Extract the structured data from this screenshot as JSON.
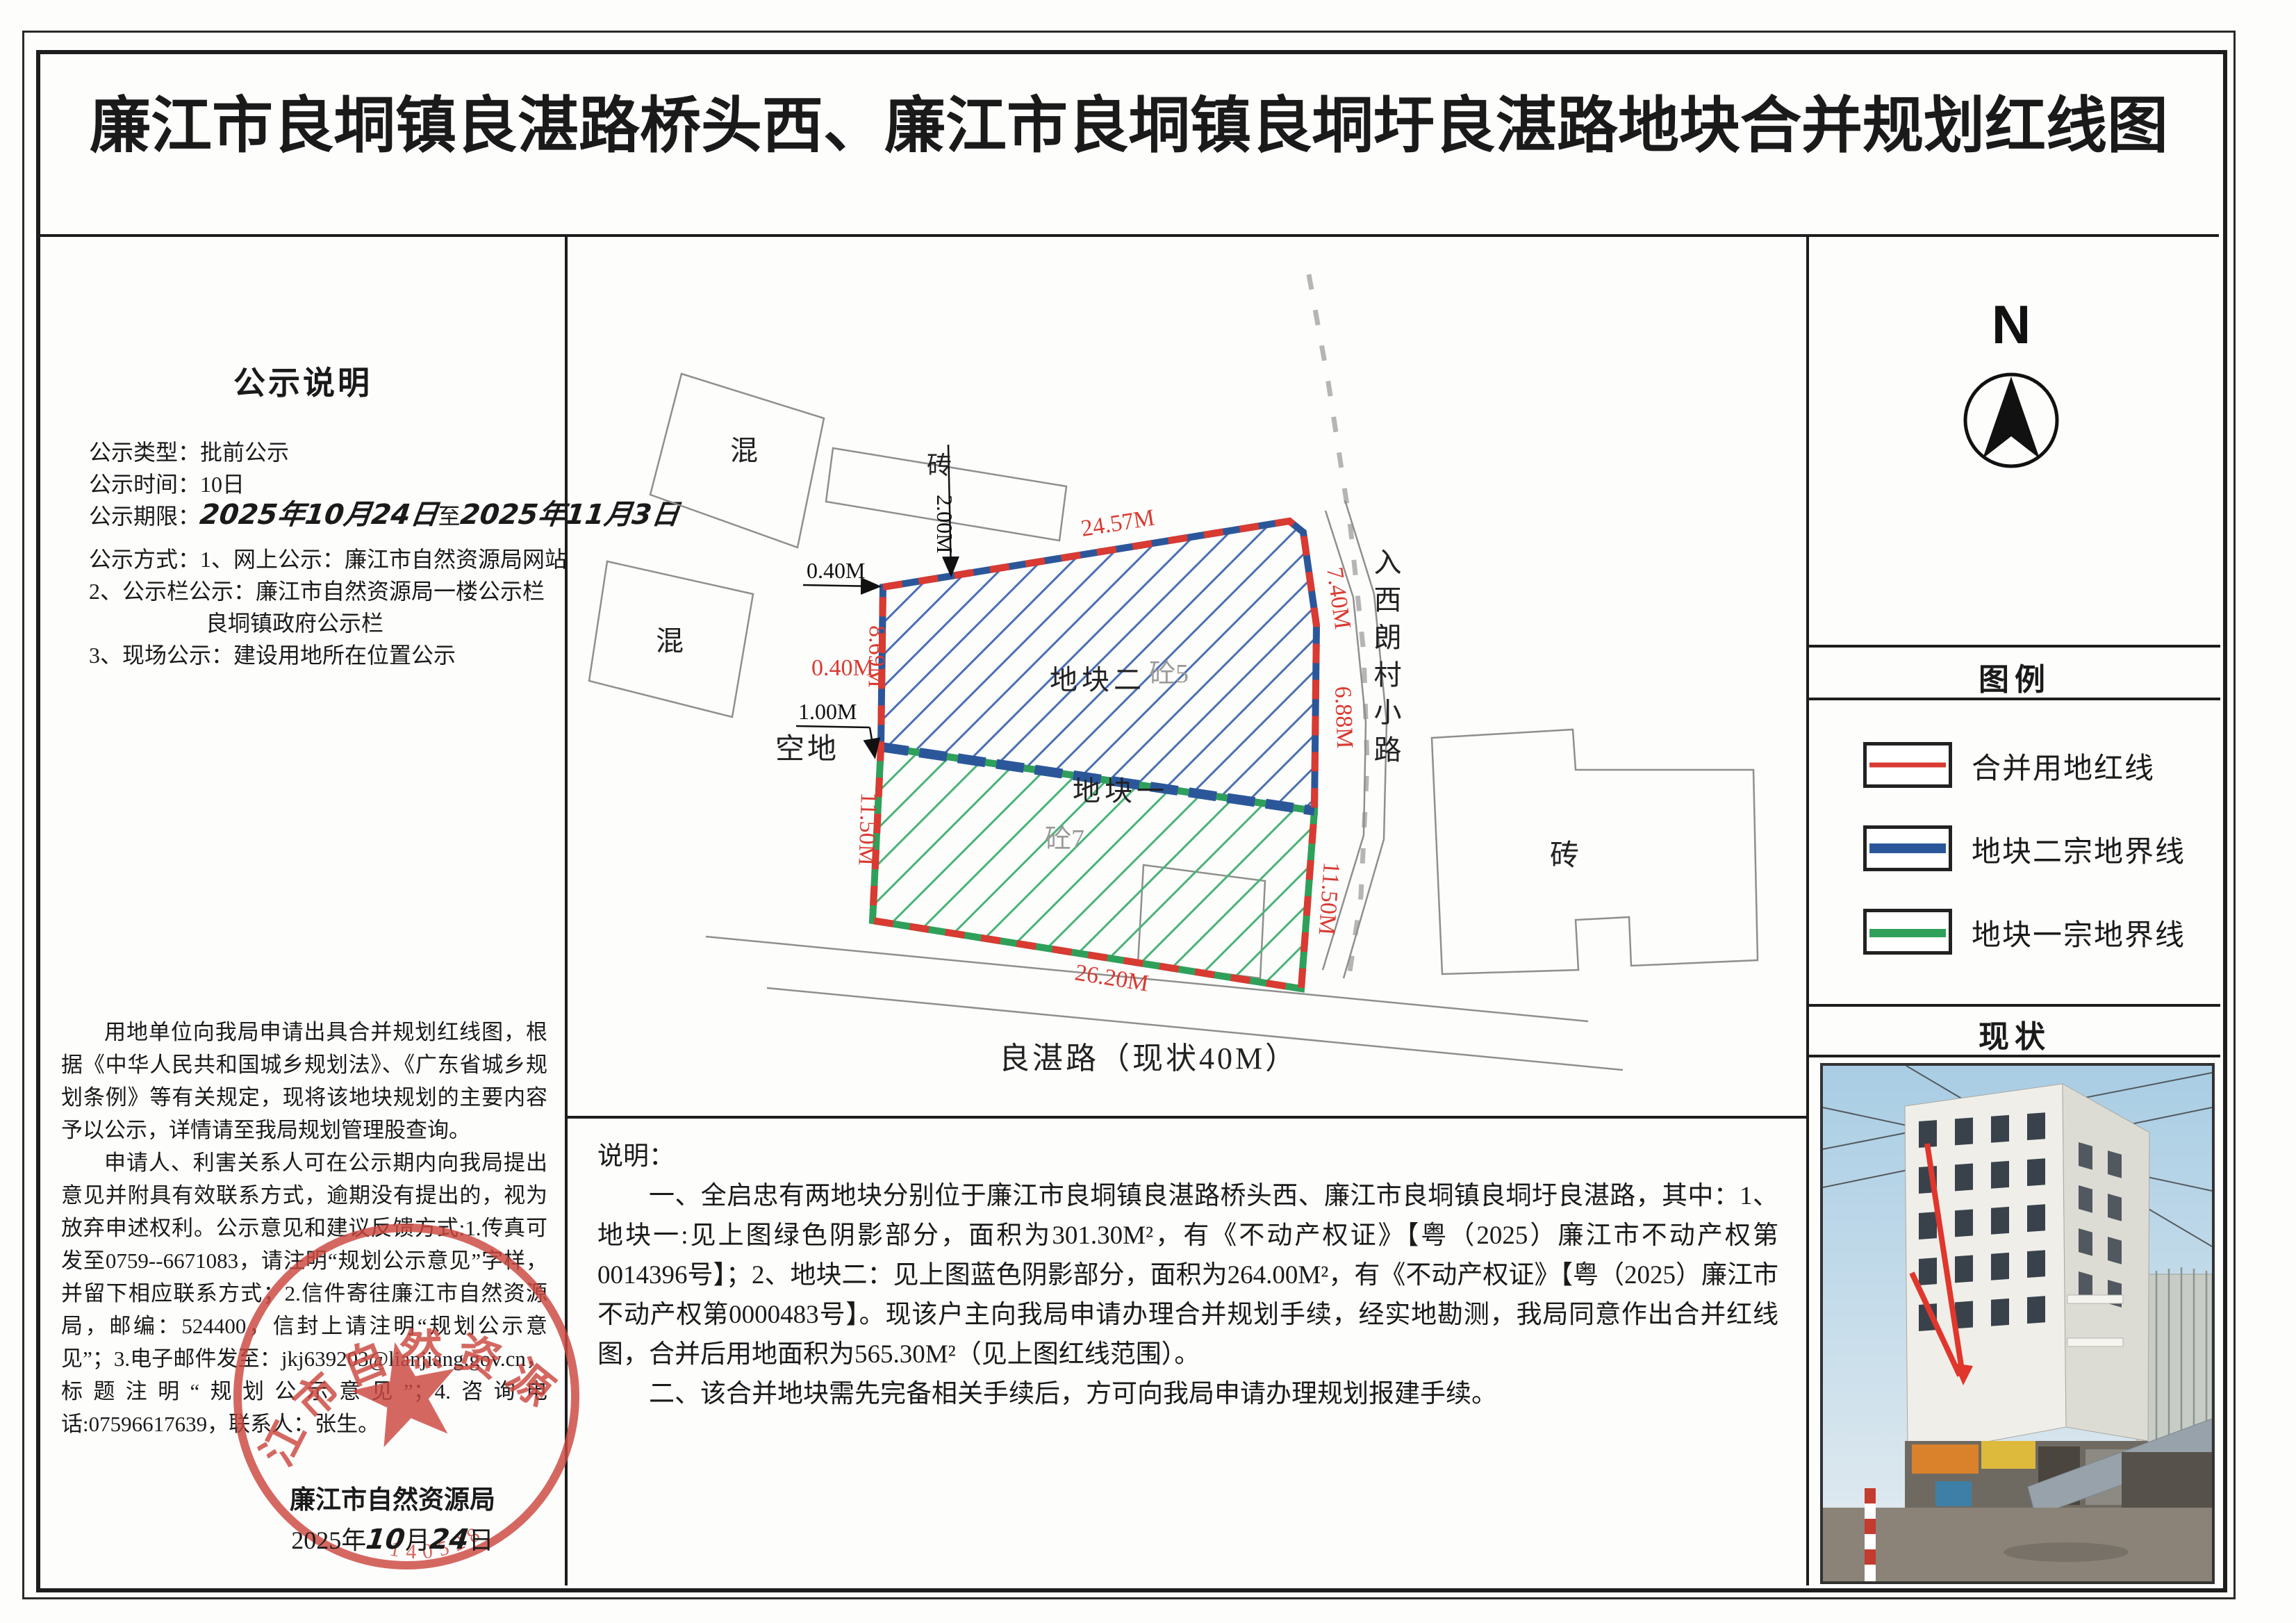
{
  "title": "廉江市良垌镇良湛路桥头西、廉江市良垌镇良垌圩良湛路地块合并规划红线图",
  "colors": {
    "red_line": "#d93a31",
    "blue_line": "#2b579a",
    "green_line": "#2fa05a",
    "stamp_red": "#cc4840"
  },
  "left_panel": {
    "heading": "公示说明",
    "line_type": "公示类型：批前公示",
    "line_time": "公示时间：10日",
    "line_period_label": "公示期限：",
    "period_start": "2025年10月24日",
    "period_join": "至",
    "period_end": "2025年11月3日",
    "line_method": "公示方式：1、网上公示：廉江市自然资源局网站",
    "line_board": "2、公示栏公示：廉江市自然资源局一楼公示栏",
    "line_board2": "良垌镇政府公示栏",
    "line_site": "3、现场公示：建设用地所在位置公示",
    "para1": "用地单位向我局申请出具合并规划红线图，根据《中华人民共和国城乡规划法》、《广东省城乡规划条例》等有关规定，现将该地块规划的主要内容予以公示，详情请至我局规划管理股查询。",
    "para2": "申请人、利害关系人可在公示期内向我局提出意见并附具有效联系方式，逾期没有提出的，视为放弃申述权利。公示意见和建议反馈方式:1.传真可发至0759--6671083，请注明“规划公示意见”字样，并留下相应联系方式；2.信件寄往廉江市自然资源局，邮编：524400，信封上请注明“规划公示意见”；3.电子邮件发至：jkj639203@lianjiang.gov.cn，标题注明“规划公示意见”；4.咨询电话:07596617639，联系人：张生。",
    "agency": "廉江市自然资源局",
    "date_year": "2025年",
    "date_month_hand": "10",
    "date_month_unit": "月",
    "date_day_hand": "24",
    "date_day_unit": "日"
  },
  "stamp": {
    "agency": "廉江市自然资源局",
    "serial": "140528"
  },
  "map": {
    "labels": {
      "parcel2": "地块二",
      "parcel2_note": "砼5",
      "parcel1": "地块一",
      "parcel1_note": "砼7",
      "vacant": "空地",
      "concrete_a": "混",
      "concrete_b": "混",
      "brick_top": "砖",
      "brick_right": "砖",
      "side_road": "入西朗村小路",
      "bottom_road": "良湛路（现状40M）"
    },
    "dims": {
      "top": "24.57M",
      "right_a": "7.40M",
      "right_b": "6.88M",
      "right_c": "11.50M",
      "bottom": "26.20M",
      "left_lower": "11.50M",
      "left_upper": "8.69M",
      "offset_a": "0.40M",
      "offset_b": "0.40M",
      "offset_c": "1.00M",
      "setback": "2.00M"
    }
  },
  "north": {
    "letter": "N"
  },
  "legend": {
    "header": "图例",
    "items": [
      {
        "label": "合并用地红线",
        "color": "#d93a31",
        "thickness": 7
      },
      {
        "label": "地块二宗地界线",
        "color": "#2b579a",
        "thickness": 14
      },
      {
        "label": "地块一宗地界线",
        "color": "#2fa05a",
        "thickness": 12
      }
    ]
  },
  "status": {
    "header": "现状"
  },
  "notes": {
    "heading": "说明：",
    "para1": "一、全启忠有两地块分别位于廉江市良垌镇良湛路桥头西、廉江市良垌镇良垌圩良湛路，其中：1、地块一:见上图绿色阴影部分，面积为301.30M²，有《不动产权证》【粤（2025）廉江市不动产权第0014396号】；2、地块二：见上图蓝色阴影部分，面积为264.00M²，有《不动产权证》【粤（2025）廉江市不动产权第0000483号】。现该户主向我局申请办理合并规划手续，经实地勘测，我局同意作出合并红线图，合并后用地面积为565.30M²（见上图红线范围）。",
    "para2": "二、该合并地块需先完备相关手续后，方可向我局申请办理规划报建手续。"
  }
}
